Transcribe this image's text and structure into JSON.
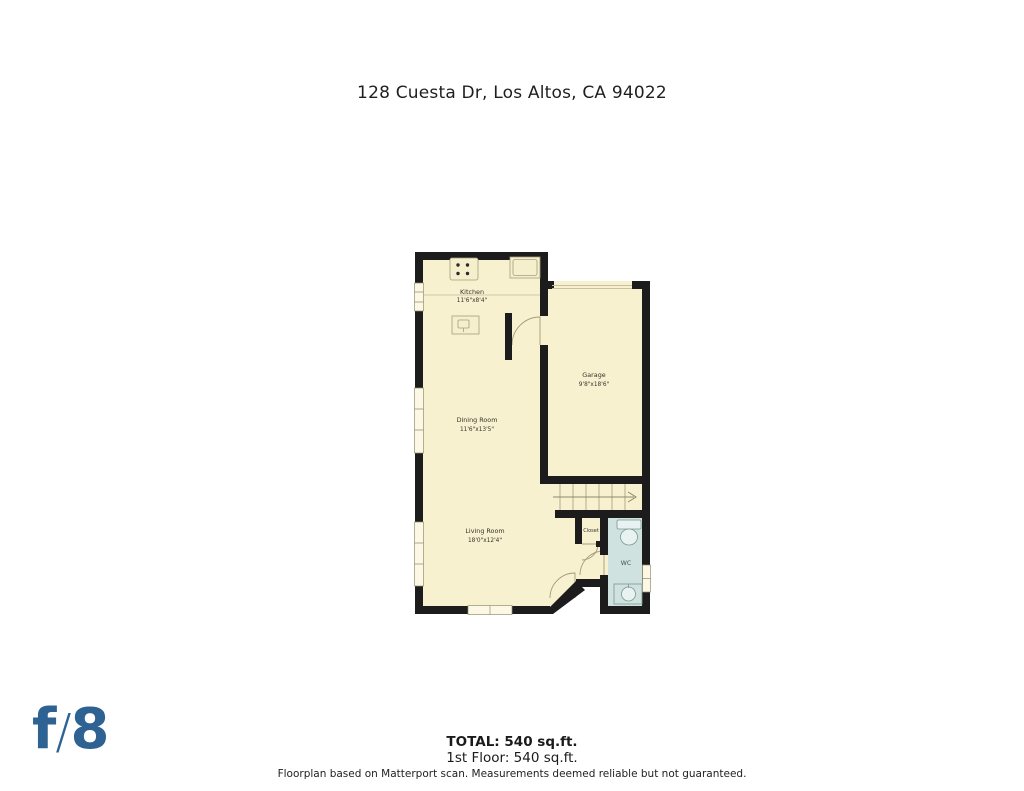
{
  "page": {
    "title": "128 Cuesta Dr, Los Altos, CA 94022"
  },
  "plan": {
    "colors": {
      "floor": "#f8f1d0",
      "wall": "#1c1c1c",
      "wc_floor": "#cfe2e0",
      "window": "#fdf8e6"
    },
    "rooms": {
      "kitchen": {
        "name": "Kitchen",
        "dims": "11'6\"x8'4\""
      },
      "dining": {
        "name": "Dining Room",
        "dims": "11'6\"x13'5\""
      },
      "garage": {
        "name": "Garage",
        "dims": "9'8\"x18'6\""
      },
      "living": {
        "name": "Living Room",
        "dims": "18'0\"x12'4\""
      },
      "closet": {
        "name": "Closet"
      },
      "wc": {
        "name": "WC"
      }
    }
  },
  "footer": {
    "total_label": "TOTAL: 540 sq.ft.",
    "first_floor_label": "1st Floor: 540 sq.ft.",
    "disclaimer": "Floorplan based on Matterport scan. Measurements deemed reliable but not guaranteed.",
    "logo": {
      "f": "f",
      "slash": "/",
      "eight": "8",
      "color": "#2d6292"
    }
  }
}
